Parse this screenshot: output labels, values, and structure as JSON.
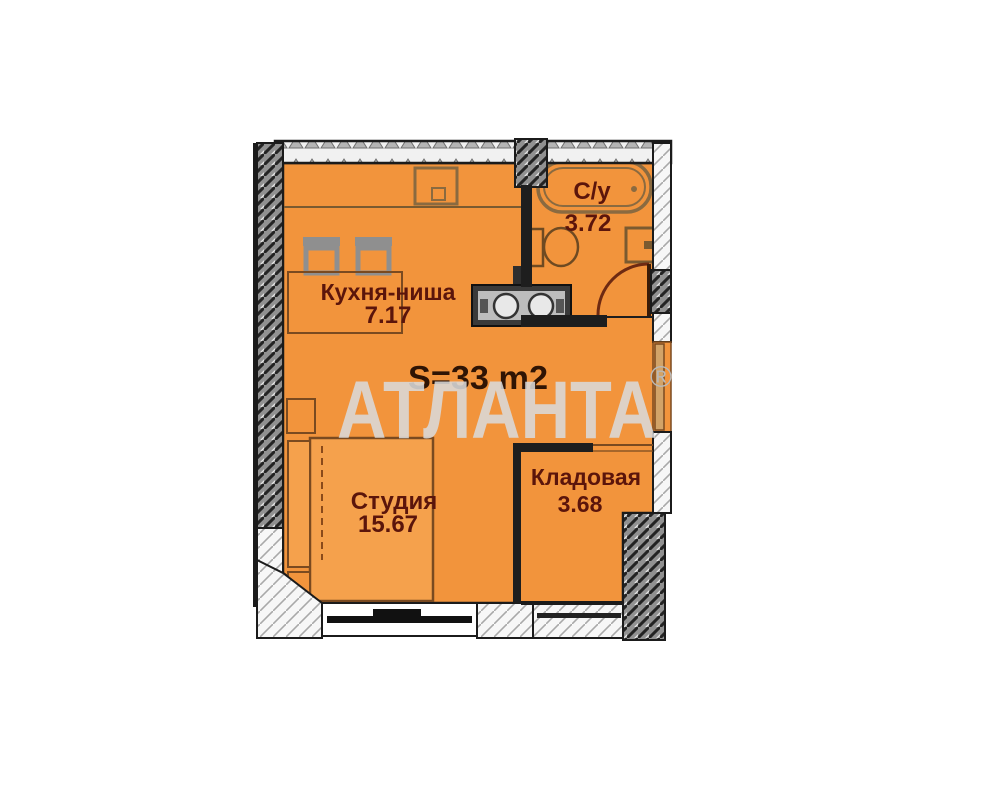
{
  "plan": {
    "title": "Apartment floor plan",
    "total_area_label": "S=33 m2",
    "watermark": {
      "text": "АТЛАНТА",
      "registered_mark": "®"
    },
    "rooms": [
      {
        "id": "kitchen",
        "name": "Кухня-ниша",
        "area": "7.17"
      },
      {
        "id": "bathroom",
        "name": "С/у",
        "area": "3.72"
      },
      {
        "id": "studio",
        "name": "Студия",
        "area": "15.67"
      },
      {
        "id": "storage",
        "name": "Кладовая",
        "area": "3.68"
      }
    ],
    "fixtures": [
      {
        "icon": "bathtub-icon"
      },
      {
        "icon": "toilet-icon"
      },
      {
        "icon": "wall-sink-icon"
      },
      {
        "icon": "kitchen-sink-unit-icon"
      },
      {
        "icon": "stool-icon"
      },
      {
        "icon": "stool-icon"
      },
      {
        "icon": "vent-box-icon"
      },
      {
        "icon": "bed-icon"
      },
      {
        "icon": "door-swing-icon"
      },
      {
        "icon": "entry-door-icon"
      },
      {
        "icon": "window-icon"
      },
      {
        "icon": "window-icon"
      }
    ],
    "colors": {
      "floor_orange": "#F2943C",
      "bed_orange": "#F5A14C",
      "wall_black": "#1b1b1b",
      "wall_gray": "#8f8f8f",
      "hatch_light": "#9a9a9a",
      "furniture_brown": "#7a4a20",
      "door_brown": "#6e2a12",
      "label_maroon": "#5b150b",
      "total_area_dark": "#2f1404",
      "watermark_gray": "#d9d9d9",
      "tan_door": "#d2a368"
    }
  }
}
